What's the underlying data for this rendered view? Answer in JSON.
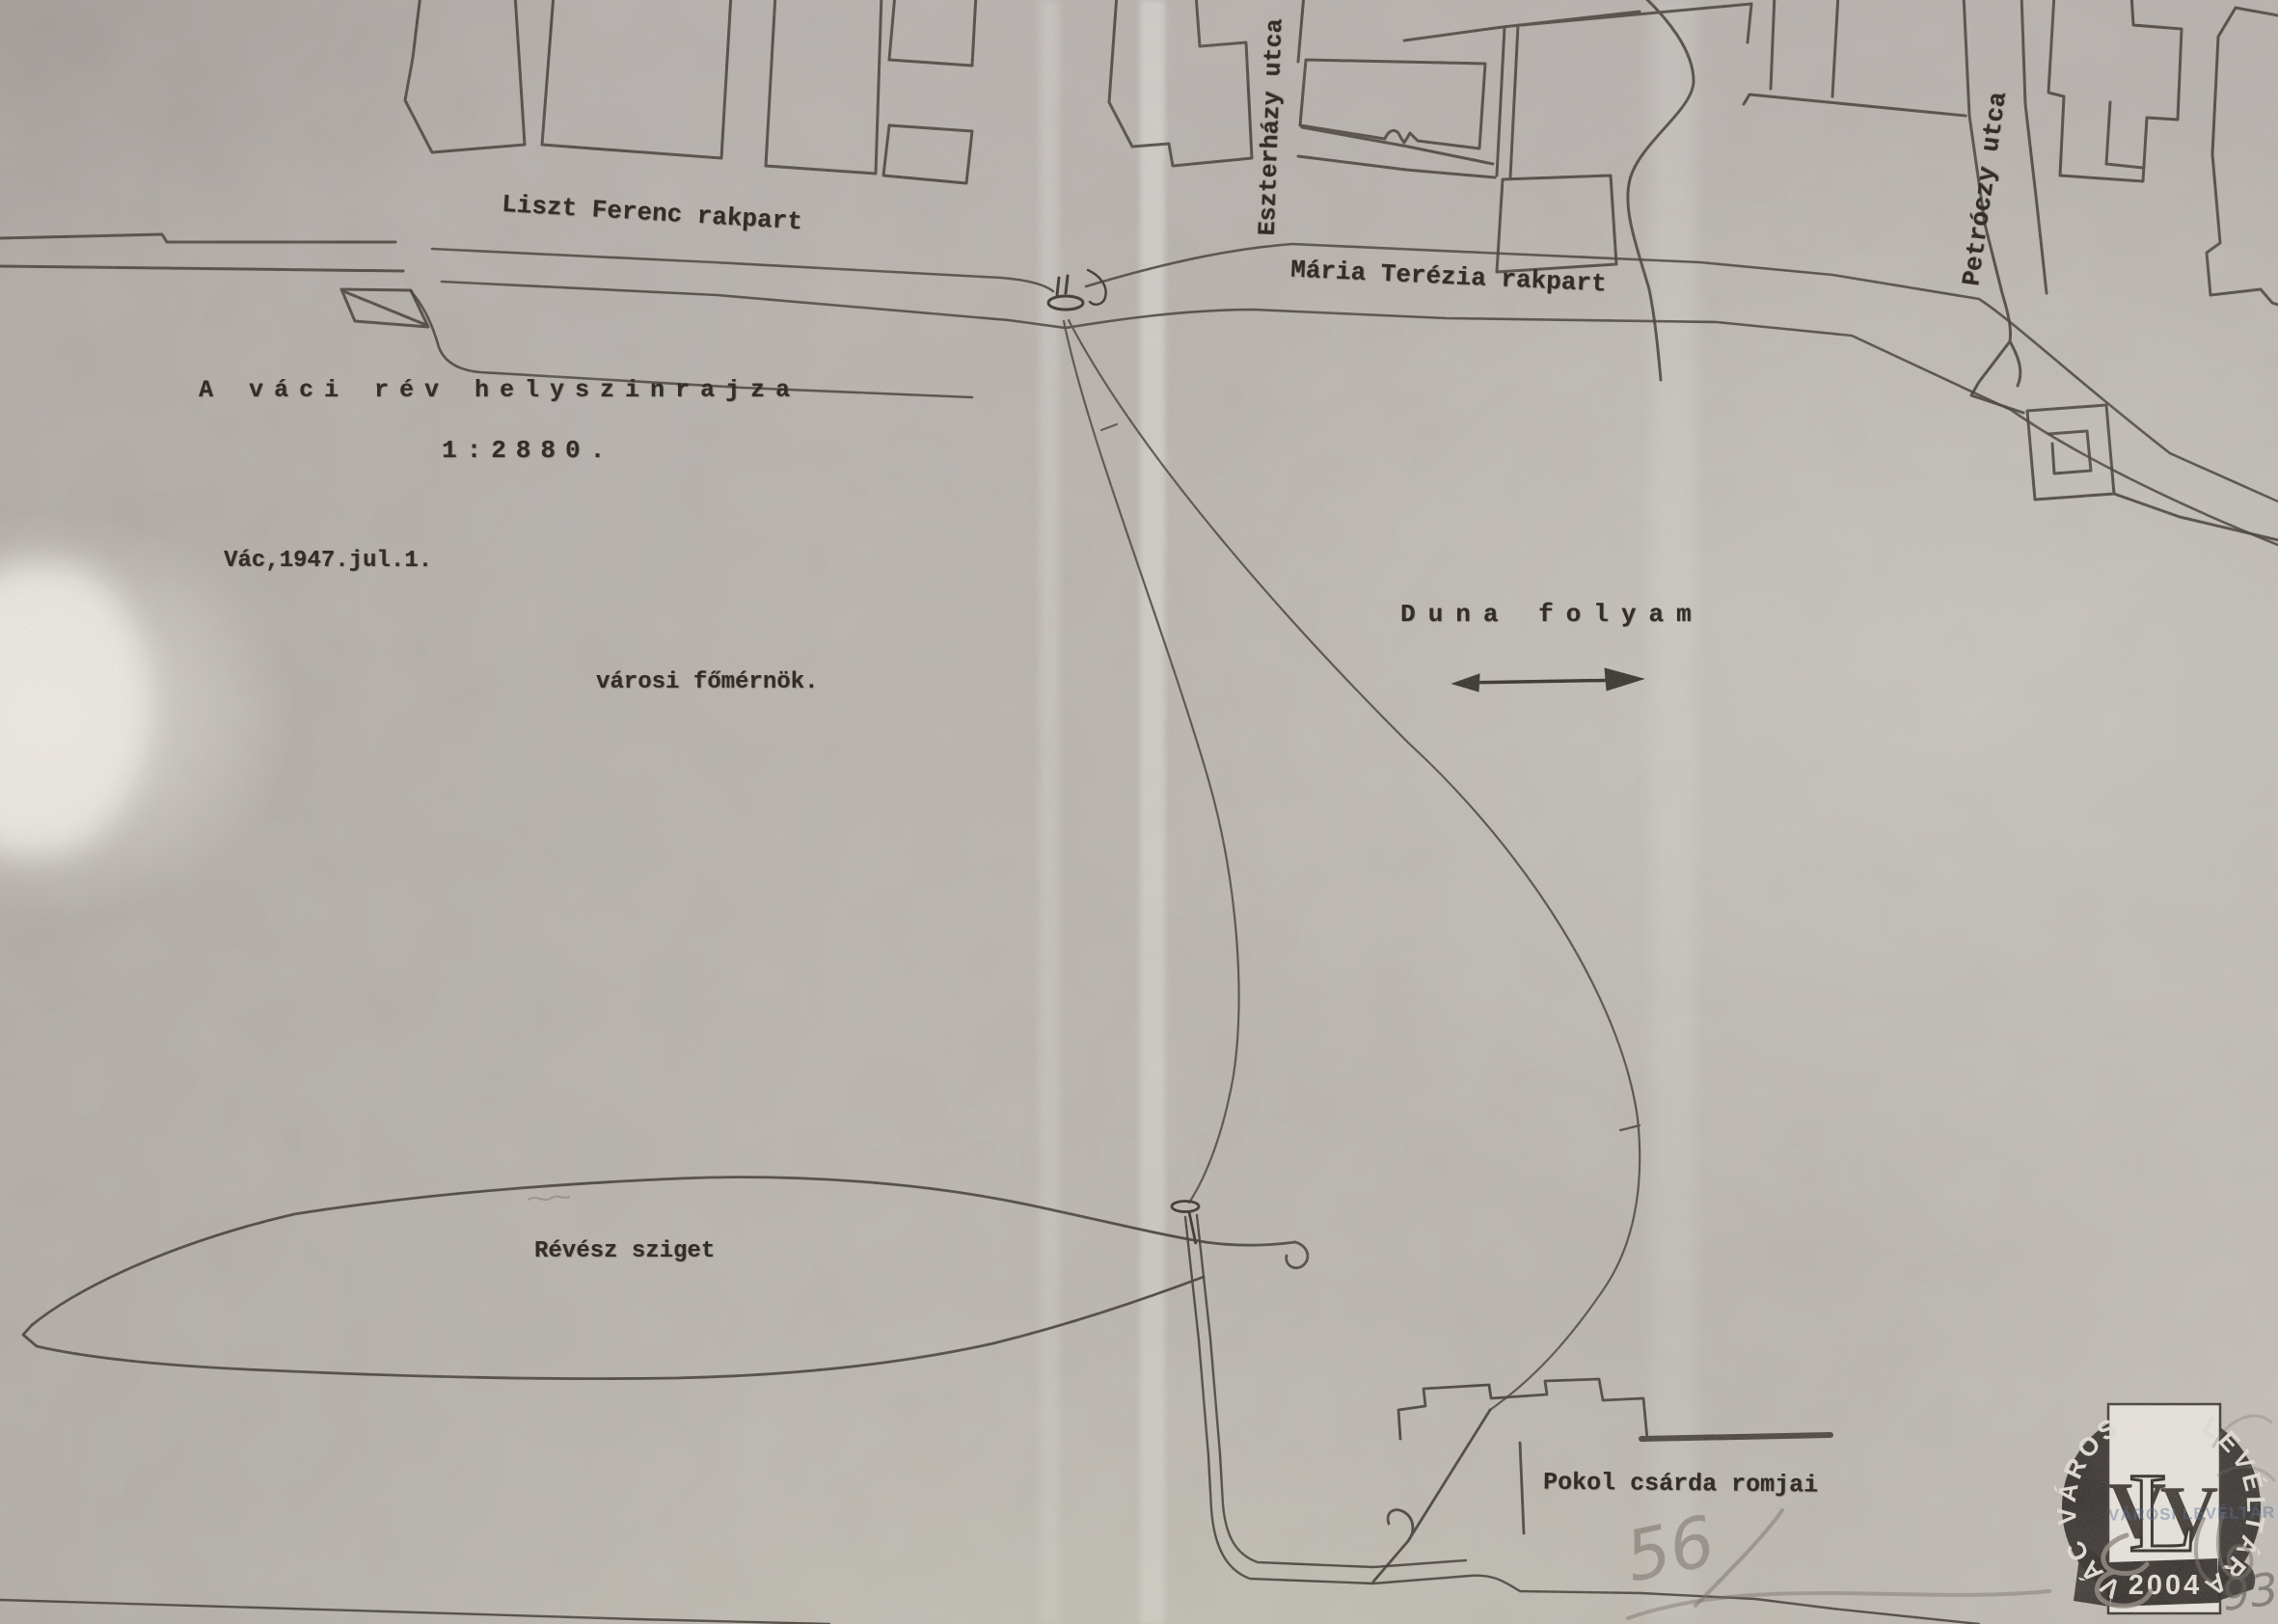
{
  "map": {
    "title": "A váci rév helyszinrajza",
    "scale": "1:2880.",
    "date_line": "Vác,1947.jul.1.",
    "signature": "városi főmérnök.",
    "labels": {
      "liszt_quay": "Liszt Ferenc rakpart",
      "maria_quay": "Mária Terézia rakpart",
      "eszterhazy_street": "Eszterházy utca",
      "petroczy_street": "Petróczy utca",
      "danube": "Duna folyam",
      "island": "Révész sziget",
      "pokol_ruins": "Pokol csárda romjai"
    },
    "icons": {
      "flow_arrow": "right-arrow-icon",
      "ferry_pier": "pier-ellipse-icon",
      "island_pier": "pier-pin-icon"
    }
  },
  "stamp": {
    "arc_left": "VÁC VÁROS",
    "arc_right": "LEVÉLTÁRA",
    "monogram_v1": "V",
    "monogram_l": "L",
    "monogram_v2": "V",
    "year": "2004",
    "overprint": "VÁROSI LEVÉLTÁR"
  },
  "annotations": {
    "pencil_left": "56",
    "pencil_corner": "932/"
  },
  "colors": {
    "paper": "#b7b1ae",
    "ink": "#38322d",
    "stamp_dark": "#27221f",
    "stamp_light": "#e9e5de",
    "pencil": "#6e6761",
    "overprint_blue": "#5e749b"
  }
}
